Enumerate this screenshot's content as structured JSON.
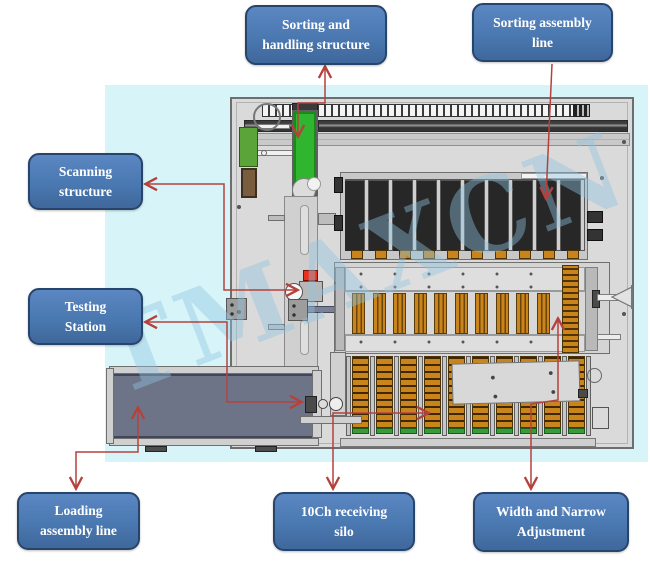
{
  "watermark": {
    "text": "TMAXCN"
  },
  "colors": {
    "label_fill": "#4a78b0",
    "label_border": "#27456b",
    "label_text": "#ffffff",
    "arrow_red": "#b5413c",
    "panel_cyan": "#d7f5f9",
    "machine_gray": "#dadada",
    "tray_dark": "#272727",
    "component_orange": "#c9841c",
    "belt_green": "#2fb52f",
    "conveyor_slate": "#6e7488"
  },
  "labels": {
    "sorting_handling": {
      "lines": [
        "Sorting and",
        "handling structure"
      ]
    },
    "sorting_line": {
      "lines": [
        "Sorting assembly",
        "line"
      ]
    },
    "scanning": {
      "lines": [
        "Scanning",
        "structure"
      ]
    },
    "testing": {
      "lines": [
        "Testing",
        "Station"
      ]
    },
    "loading": {
      "lines": [
        "Loading",
        "assembly line"
      ]
    },
    "silo": {
      "lines": [
        "10Ch receiving",
        "silo"
      ]
    },
    "width_adjust": {
      "lines": [
        "Width and Narrow",
        "Adjustment"
      ]
    }
  },
  "machine": {
    "sorting_channels": 10,
    "tray_channels": 10,
    "silo_channels": 10
  }
}
